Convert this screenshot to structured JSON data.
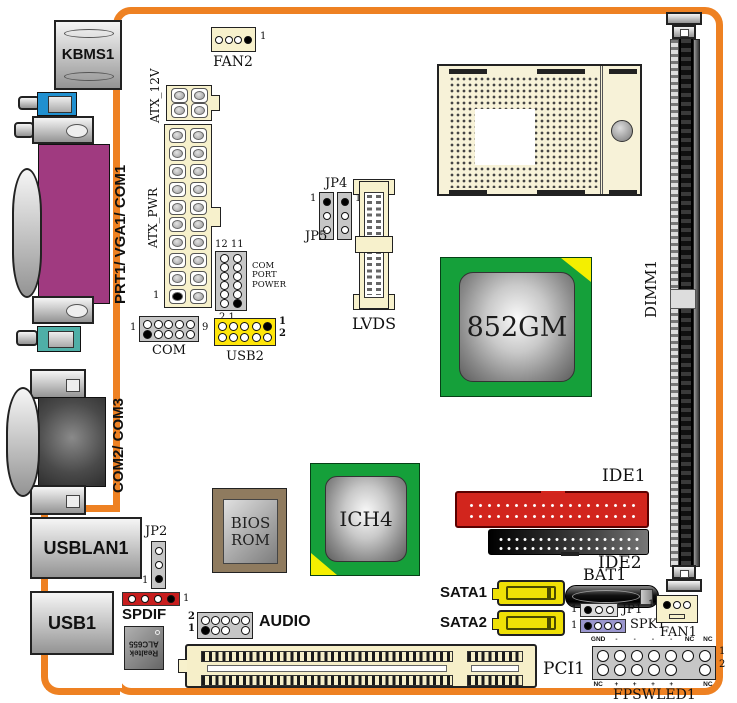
{
  "io_ports": {
    "kbms1": "KBMS1",
    "prt1_vga1_com1": "PRT1/ VGA1/ COM1",
    "com2_com3": "COM2/ COM3",
    "usblan1": "USBLAN1",
    "usb1": "USB1"
  },
  "chips": {
    "northbridge": "852GM",
    "southbridge": "ICH4",
    "bios": "BIOS\nROM",
    "audio_codec": "Realtek\nALC655"
  },
  "headers": {
    "fan2": {
      "label": "FAN2",
      "pin1": "1"
    },
    "atx_12v": {
      "label": "ATX_12V"
    },
    "atx_pwr": {
      "label": "ATX_PWR",
      "pin1": "1"
    },
    "com_port_power": {
      "label": "COM\nPORT\nPOWER",
      "pins_top": "12 11",
      "pins_bottom": "2  1"
    },
    "com": {
      "label": "COM",
      "pin1": "1",
      "pin9": "9"
    },
    "usb2": {
      "label": "USB2",
      "pin1": "1",
      "pin2": "2"
    },
    "jp4": {
      "label": "JP4",
      "pin1": "1"
    },
    "jp5": {
      "label": "JP5",
      "pin1": "1"
    },
    "lvds": {
      "label": "LVDS"
    },
    "dimm1": {
      "label": "DIMM1"
    },
    "ide1": {
      "label": "IDE1"
    },
    "ide2": {
      "label": "IDE2"
    },
    "sata1": {
      "label": "SATA1"
    },
    "sata2": {
      "label": "SATA2"
    },
    "bat1": {
      "label": "BAT1"
    },
    "jp1": {
      "label": "JP1",
      "pin1": "1"
    },
    "spk1": {
      "label": "SPK1",
      "pin1": "1"
    },
    "fan1": {
      "label": "FAN1",
      "pin1": "1"
    },
    "pci1": {
      "label": "PCI1"
    },
    "jp2": {
      "label": "JP2",
      "pin1": "1"
    },
    "spdif": {
      "label": "SPDIF",
      "pin1": "1"
    },
    "audio": {
      "label": "AUDIO",
      "pin1": "1",
      "pin2": "2"
    },
    "fpswled1": {
      "label": "FPSWLED1",
      "pin1": "1",
      "pin2": "2",
      "top_labels": [
        "GND",
        "-",
        "-",
        "-",
        "-",
        "NC",
        "NC"
      ],
      "bottom_labels": [
        "NC",
        "+",
        "+",
        "+",
        "+",
        "",
        "NC"
      ]
    }
  },
  "colors": {
    "frame_orange": "#EE8122",
    "chip_green": "#15A03A",
    "ide1_red": "#D2251D",
    "usb2_yellow": "#FFE60A",
    "sata_yellow": "#EFE006",
    "port_purple": "#A03A80"
  }
}
